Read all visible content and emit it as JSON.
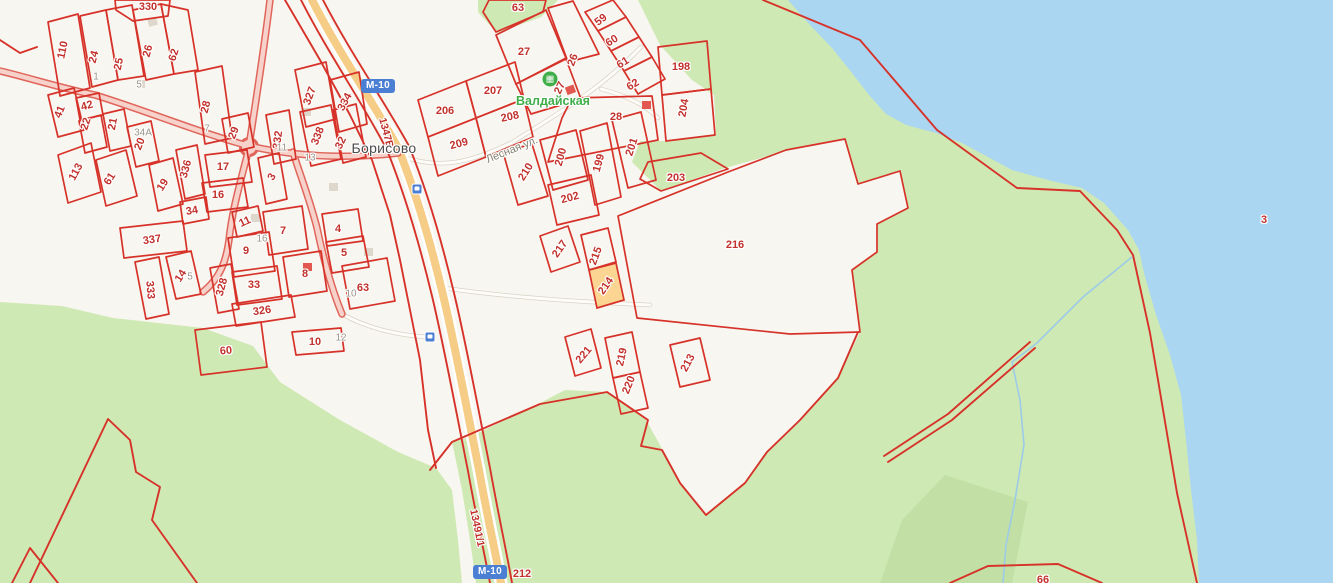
{
  "map": {
    "place_label": "Борисово",
    "street_label": "Лесная ул.",
    "poi": {
      "name": "Валдайская",
      "icon": "recreation-base-icon",
      "x": 550,
      "y": 79,
      "text_x": 553,
      "text_y": 101
    },
    "shield_text": "М-10",
    "shields": [
      {
        "x": 378,
        "y": 86
      },
      {
        "x": 490,
        "y": 572
      }
    ],
    "road_codes": [
      {
        "text": "1347В",
        "x": 386,
        "y": 133,
        "r": 75
      },
      {
        "text": "13491/1",
        "x": 477,
        "y": 528,
        "r": 78
      }
    ],
    "bus_stops": [
      {
        "x": 417,
        "y": 189
      },
      {
        "x": 430,
        "y": 337
      }
    ],
    "selected_parcel": "214",
    "parcel_labels": [
      {
        "t": "330",
        "x": 148,
        "y": 7,
        "r": 0
      },
      {
        "t": "110",
        "x": 63,
        "y": 50,
        "r": -78
      },
      {
        "t": "24",
        "x": 94,
        "y": 57,
        "r": -75
      },
      {
        "t": "25",
        "x": 119,
        "y": 64,
        "r": -78
      },
      {
        "t": "26",
        "x": 148,
        "y": 51,
        "r": -75
      },
      {
        "t": "62",
        "x": 174,
        "y": 55,
        "r": -72
      },
      {
        "t": "41",
        "x": 60,
        "y": 112,
        "r": -68
      },
      {
        "t": "42",
        "x": 87,
        "y": 106,
        "r": -15
      },
      {
        "t": "22",
        "x": 86,
        "y": 124,
        "r": -72
      },
      {
        "t": "21",
        "x": 113,
        "y": 124,
        "r": -80
      },
      {
        "t": "20",
        "x": 140,
        "y": 144,
        "r": -68
      },
      {
        "t": "28",
        "x": 206,
        "y": 107,
        "r": -75
      },
      {
        "t": "29",
        "x": 234,
        "y": 133,
        "r": -68
      },
      {
        "t": "327",
        "x": 310,
        "y": 96,
        "r": -70
      },
      {
        "t": "334",
        "x": 345,
        "y": 102,
        "r": -62
      },
      {
        "t": "332",
        "x": 278,
        "y": 140,
        "r": -82
      },
      {
        "t": "338",
        "x": 318,
        "y": 136,
        "r": -68
      },
      {
        "t": "32",
        "x": 341,
        "y": 143,
        "r": -65
      },
      {
        "t": "113",
        "x": 76,
        "y": 172,
        "r": -62
      },
      {
        "t": "61",
        "x": 110,
        "y": 179,
        "r": -58
      },
      {
        "t": "19",
        "x": 163,
        "y": 185,
        "r": -58
      },
      {
        "t": "336",
        "x": 186,
        "y": 169,
        "r": -75
      },
      {
        "t": "34",
        "x": 192,
        "y": 211,
        "r": -10
      },
      {
        "t": "337",
        "x": 152,
        "y": 240,
        "r": -8
      },
      {
        "t": "17",
        "x": 223,
        "y": 167,
        "r": 0
      },
      {
        "t": "16",
        "x": 218,
        "y": 195,
        "r": 0
      },
      {
        "t": "3",
        "x": 272,
        "y": 177,
        "r": -60
      },
      {
        "t": "11",
        "x": 245,
        "y": 222,
        "r": -25
      },
      {
        "t": "7",
        "x": 283,
        "y": 231,
        "r": 0
      },
      {
        "t": "9",
        "x": 246,
        "y": 251,
        "r": 0
      },
      {
        "t": "4",
        "x": 338,
        "y": 229,
        "r": 0
      },
      {
        "t": "5",
        "x": 344,
        "y": 253,
        "r": 0
      },
      {
        "t": "8",
        "x": 305,
        "y": 274,
        "r": 0
      },
      {
        "t": "63",
        "x": 363,
        "y": 288,
        "r": 0
      },
      {
        "t": "33",
        "x": 254,
        "y": 285,
        "r": 0
      },
      {
        "t": "328",
        "x": 222,
        "y": 287,
        "r": -75
      },
      {
        "t": "326",
        "x": 262,
        "y": 311,
        "r": -8
      },
      {
        "t": "333",
        "x": 150,
        "y": 290,
        "r": 85
      },
      {
        "t": "14",
        "x": 181,
        "y": 276,
        "r": -58
      },
      {
        "t": "60",
        "x": 226,
        "y": 351,
        "r": -5
      },
      {
        "t": "10",
        "x": 315,
        "y": 342,
        "r": 0
      },
      {
        "t": "63",
        "x": 518,
        "y": 8,
        "r": 0
      },
      {
        "t": "27",
        "x": 524,
        "y": 52,
        "r": 0
      },
      {
        "t": "26",
        "x": 573,
        "y": 60,
        "r": -70
      },
      {
        "t": "59",
        "x": 601,
        "y": 20,
        "r": -38
      },
      {
        "t": "60",
        "x": 612,
        "y": 41,
        "r": -32
      },
      {
        "t": "61",
        "x": 623,
        "y": 63,
        "r": -32
      },
      {
        "t": "62",
        "x": 633,
        "y": 85,
        "r": -32
      },
      {
        "t": "198",
        "x": 681,
        "y": 67,
        "r": 0
      },
      {
        "t": "204",
        "x": 684,
        "y": 108,
        "r": -80
      },
      {
        "t": "207",
        "x": 493,
        "y": 91,
        "r": 0
      },
      {
        "t": "206",
        "x": 445,
        "y": 111,
        "r": 0
      },
      {
        "t": "208",
        "x": 510,
        "y": 117,
        "r": -12
      },
      {
        "t": "209",
        "x": 459,
        "y": 144,
        "r": -15
      },
      {
        "t": "27",
        "x": 560,
        "y": 88,
        "r": -65
      },
      {
        "t": "28",
        "x": 616,
        "y": 117,
        "r": 0
      },
      {
        "t": "203",
        "x": 676,
        "y": 178,
        "r": 0
      },
      {
        "t": "200",
        "x": 561,
        "y": 157,
        "r": -75
      },
      {
        "t": "199",
        "x": 599,
        "y": 163,
        "r": -75
      },
      {
        "t": "201",
        "x": 632,
        "y": 147,
        "r": -72
      },
      {
        "t": "210",
        "x": 526,
        "y": 172,
        "r": -58
      },
      {
        "t": "202",
        "x": 570,
        "y": 198,
        "r": -15
      },
      {
        "t": "216",
        "x": 735,
        "y": 245,
        "r": 0
      },
      {
        "t": "217",
        "x": 560,
        "y": 249,
        "r": -55
      },
      {
        "t": "215",
        "x": 596,
        "y": 256,
        "r": -70
      },
      {
        "t": "214",
        "x": 606,
        "y": 286,
        "r": -55
      },
      {
        "t": "221",
        "x": 584,
        "y": 355,
        "r": -50
      },
      {
        "t": "219",
        "x": 622,
        "y": 357,
        "r": -78
      },
      {
        "t": "220",
        "x": 629,
        "y": 385,
        "r": -68
      },
      {
        "t": "213",
        "x": 688,
        "y": 363,
        "r": -62
      },
      {
        "t": "3",
        "x": 1264,
        "y": 220,
        "r": 0
      },
      {
        "t": "212",
        "x": 522,
        "y": 574,
        "r": 0
      },
      {
        "t": "66",
        "x": 1043,
        "y": 580,
        "r": 0
      }
    ],
    "gray_labels": [
      {
        "t": "1",
        "x": 96,
        "y": 77
      },
      {
        "t": "5",
        "x": 139,
        "y": 85
      },
      {
        "t": "34А",
        "x": 143,
        "y": 133
      },
      {
        "t": "7",
        "x": 207,
        "y": 129
      },
      {
        "t": "11",
        "x": 282,
        "y": 148
      },
      {
        "t": "13",
        "x": 310,
        "y": 158
      },
      {
        "t": "16",
        "x": 262,
        "y": 239
      },
      {
        "t": "5",
        "x": 190,
        "y": 277
      },
      {
        "t": "10",
        "x": 351,
        "y": 294
      },
      {
        "t": "12",
        "x": 341,
        "y": 338
      }
    ],
    "colors": {
      "bg": "#f8f6f0",
      "forest": "#cfe9b4",
      "forest_dark": "#c2e0a6",
      "water": "#aad6f2",
      "stream": "#9ccbe8",
      "cadastral_red": "#d63229",
      "label_red": "#c2312b",
      "selected_fill": "#fbd186",
      "highway_orange": "#f6cd86",
      "village_road_casing": "#e0665c",
      "village_road_core": "#f6d2cb",
      "gray_road_casing": "#d9d3c7",
      "shield_blue": "#4a7fd4",
      "poi_green": "#3fae49",
      "place_text": "#4a4a4a",
      "street_text": "#82806f",
      "gray_label": "#9b968b",
      "building_gray": "#ded8cc",
      "building_red": "#e2574f"
    }
  }
}
